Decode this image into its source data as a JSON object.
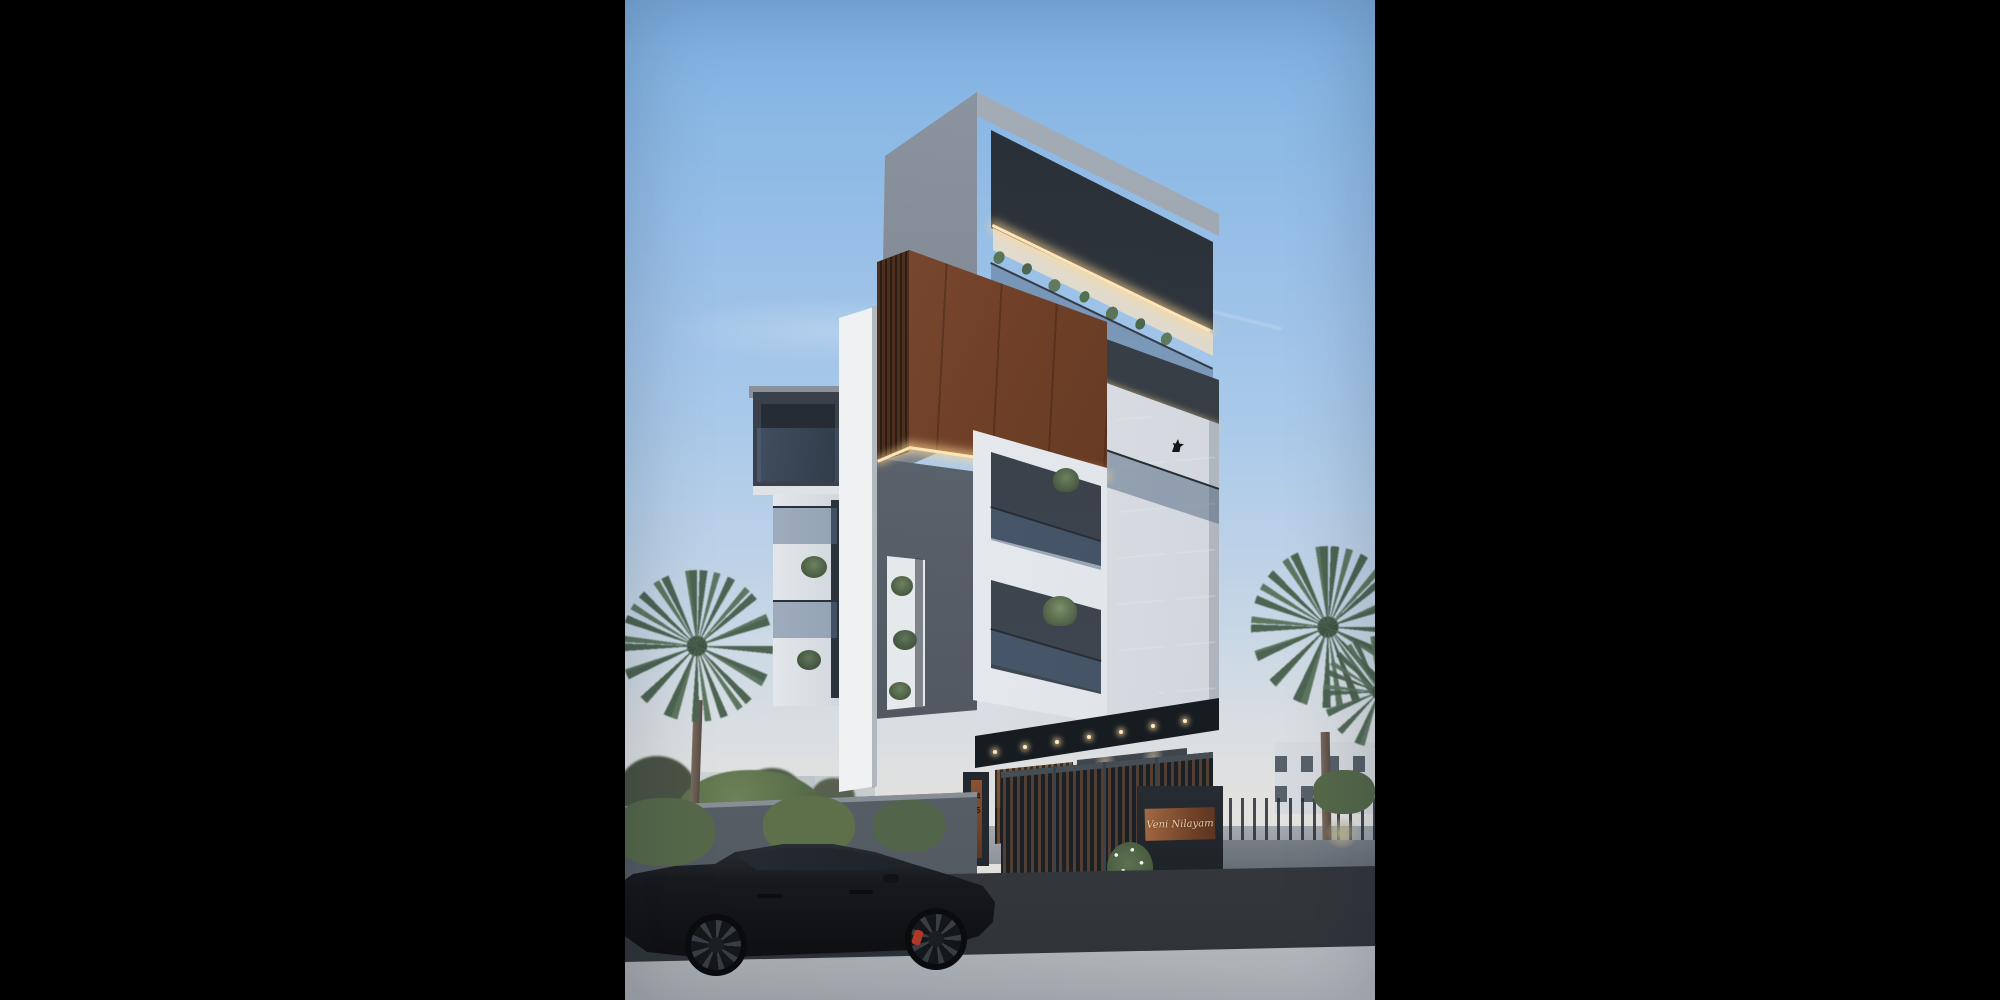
{
  "scene": {
    "title": "Modern four-storey residence — dusk architectural render",
    "time_of_day": "dusk",
    "format": "portrait render letterboxed on black canvas"
  },
  "signage": {
    "plaque_text": "Veni Nilayam",
    "house_number_top": "14",
    "house_number_bottom": "55"
  },
  "objects": {
    "building": "contemporary house with grey concrete shell, corten steel box volume and white balcony frames",
    "car": "black fastback sedan parked at kerb with red brake caliper",
    "vegetation": "fan palms, fern shrubs along footpath, balcony planters",
    "gate": "dark metal entrance gate with timber slats",
    "wall": "grey compound wall with copper house-number strip"
  },
  "palette": {
    "letterbox": "#000000",
    "sky_top": "#7fb1e3",
    "sky_mid": "#a9c9ea",
    "sky_low": "#cfdae4",
    "horizon": "#e2e1df",
    "concrete_light": "#9099a3",
    "concrete_mid": "#79818c",
    "concrete_dark": "#474e57",
    "canopy_shadow": "#262c33",
    "fascia_dark": "#3c434b",
    "white_wall": "#eef0f2",
    "white_shade": "#c9ced6",
    "corten_light": "#8c5741",
    "corten_mid": "#6f4027",
    "corten_dark": "#4a2b1c",
    "window_dark": "#2c3540",
    "glass_tint": "#5a7390",
    "led": "#ffe5b5",
    "wall_grey": "#6d747c",
    "road": "#31353a",
    "sidewalk": "#b7bdc1",
    "drive": "#60666d",
    "foliage": "#55694a",
    "palm": "#4d6452",
    "trunk": "#6e5f54",
    "car": "#17191d",
    "caliper": "#b23a26",
    "plaque_copper": "#8a5536",
    "plaque_text_color": "#ead0ac",
    "signage_stone": "#23282e"
  }
}
